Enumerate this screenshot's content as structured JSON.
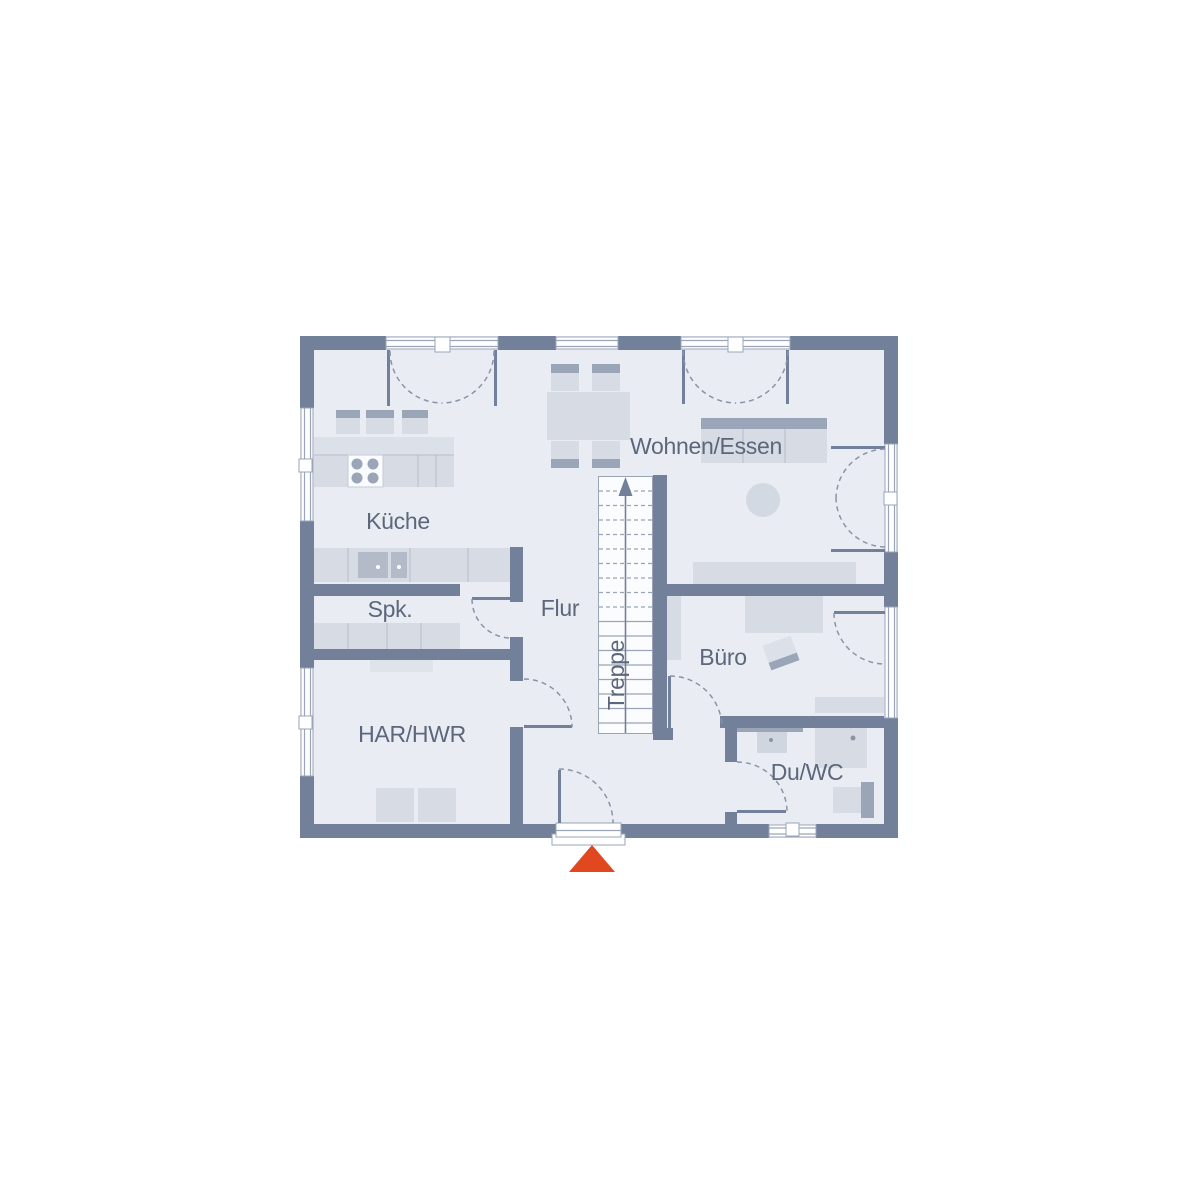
{
  "plan": {
    "type": "floor-plan",
    "rooms": {
      "kueche": {
        "label": "Küche"
      },
      "wohnen_essen": {
        "label": "Wohnen/Essen"
      },
      "flur": {
        "label": "Flur"
      },
      "spk": {
        "label": "Spk."
      },
      "treppe": {
        "label": "Treppe"
      },
      "buero": {
        "label": "Büro"
      },
      "har_hwr": {
        "label": "HAR/HWR"
      },
      "du_wc": {
        "label": "Du/WC"
      }
    },
    "icons": {
      "entrance_marker": "orange-triangle-up",
      "stairs_direction": "arrow-up"
    }
  },
  "colors": {
    "wall": "#72809A",
    "floor": "#E9EDF3",
    "furniture": "#D6DBE4",
    "furniture_accent": "#9AA5B8",
    "label_text": "#5C677B",
    "entrance_marker": "#E2481F",
    "window_line": "#9AA5B8",
    "arc_line": "#8A94A8"
  }
}
